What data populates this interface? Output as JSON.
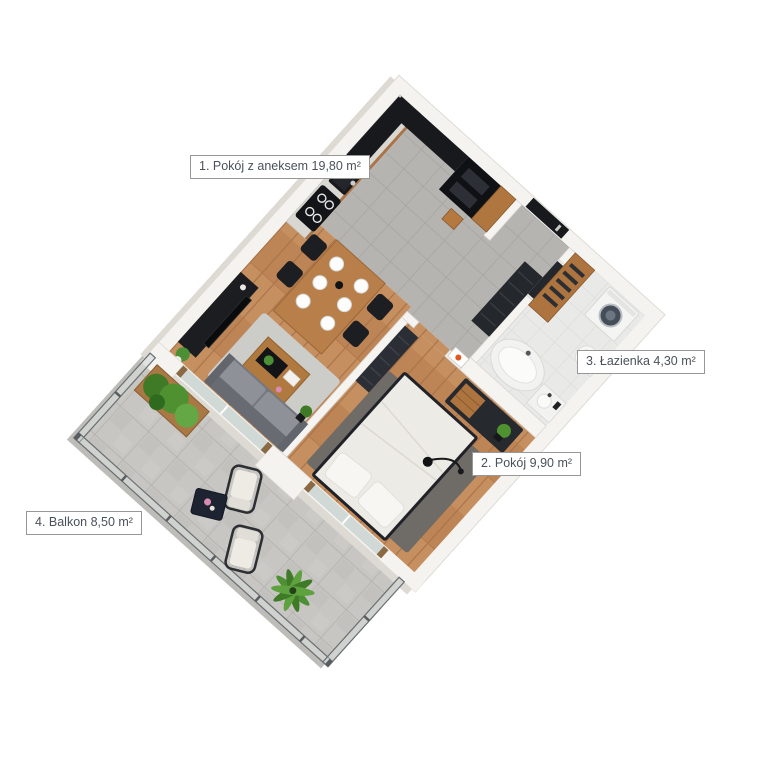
{
  "floorplan": {
    "title": "apartment-3d-floor-plan",
    "labels": [
      {
        "text": "1. Pokój z aneksem 19,80 m²",
        "number": "1",
        "room": "Pokój z aneksem",
        "area": "19,80 m²"
      },
      {
        "text": "2. Pokój 9,90 m²",
        "number": "2",
        "room": "Pokój",
        "area": "9,90 m²"
      },
      {
        "text": "3. Łazienka 4,30 m²",
        "number": "3",
        "room": "Łazienka",
        "area": "4,30 m²"
      },
      {
        "text": "4. Balkon 8,50 m²",
        "number": "4",
        "room": "Balkon",
        "area": "8,50 m²"
      }
    ],
    "colors": {
      "background": "#ffffff",
      "walls": "#f5f3f0",
      "wall_shadow": "#ddd9d3",
      "wood_floor": "#c28a5c",
      "gray_tile": "#b5b4b1",
      "white_tile": "#e9e9e7",
      "concrete_tile": "#c7c6c2",
      "dark_furniture": "#17191d",
      "wood_furniture": "#b0763f",
      "sofa_gray": "#8e9298",
      "plant_green": "#4c8f35",
      "accent_orange": "#e05a1f",
      "label_text": "#4a515a",
      "label_border": "#979797"
    }
  }
}
